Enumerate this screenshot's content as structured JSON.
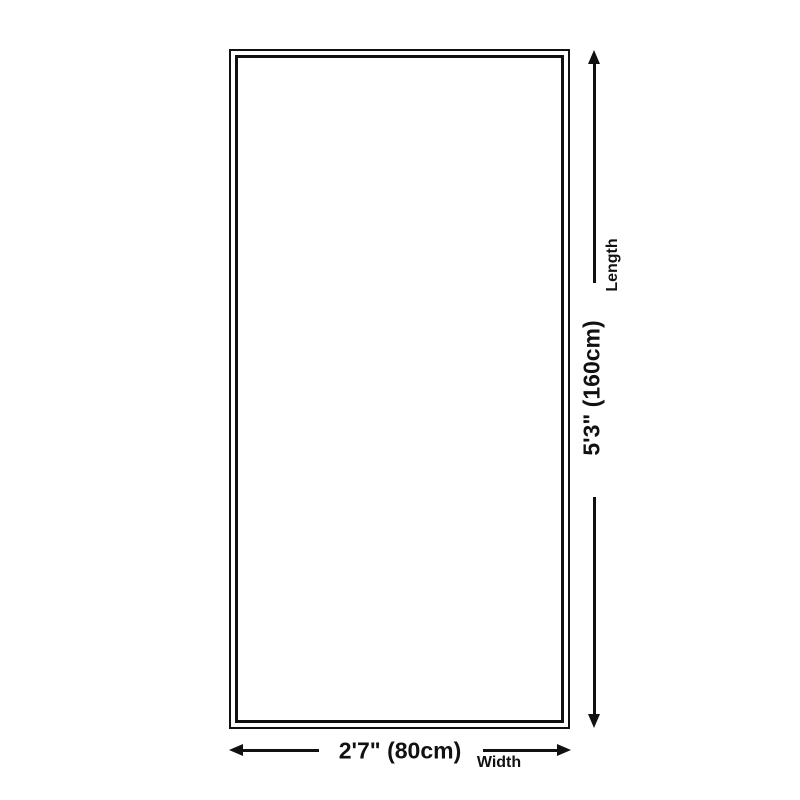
{
  "colors": {
    "background": "#ffffff",
    "line": "#111111",
    "text": "#111111"
  },
  "diagram": {
    "shape": "rectangle",
    "border_style": "double",
    "length": {
      "value": "5'3\" (160cm)",
      "label": "Length"
    },
    "width": {
      "value": "2'7\" (80cm)",
      "label": "Width"
    }
  },
  "icons": {
    "up_arrow": "▲",
    "down_arrow": "▼",
    "left_arrow": "◀",
    "right_arrow": "▶"
  }
}
